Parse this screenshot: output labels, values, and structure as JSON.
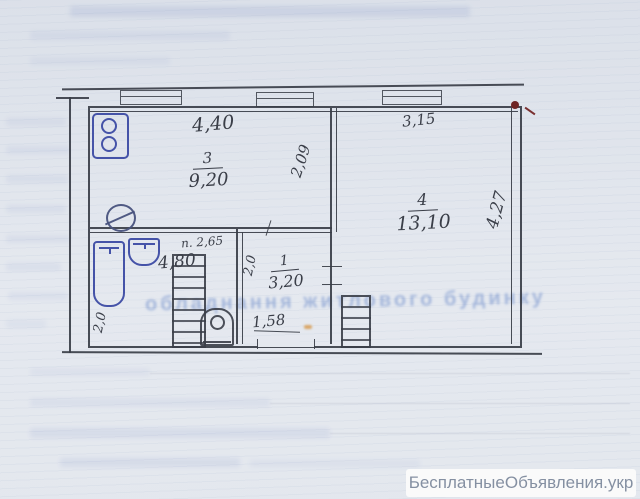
{
  "plan": {
    "rooms": {
      "kitchen": {
        "number": "3",
        "area": "9,20"
      },
      "living": {
        "number": "4",
        "area": "13,10"
      },
      "hall": {
        "number": "1",
        "area": "3,20"
      },
      "bath": {
        "area": "4,80"
      }
    },
    "dimensions": {
      "top_width_left": "4,40",
      "top_width_right": "3,15",
      "inner_depth": "2,09",
      "right_height": "4,27",
      "ceiling_height": "п. 2,65",
      "bath_width": "2,0",
      "hall_width": "2,0",
      "hall_opening": "1,58"
    }
  },
  "background": {
    "bleed_text": "обладнання житлового будинку"
  },
  "watermark": {
    "label": "БесплатныеОбъявления.укр"
  },
  "colors": {
    "paper": "#e3e7ee",
    "pencil": "#3a3e48",
    "ink_blue": "#4553a8",
    "mark_red": "#6e2424",
    "watermark_text": "#8590a2"
  }
}
